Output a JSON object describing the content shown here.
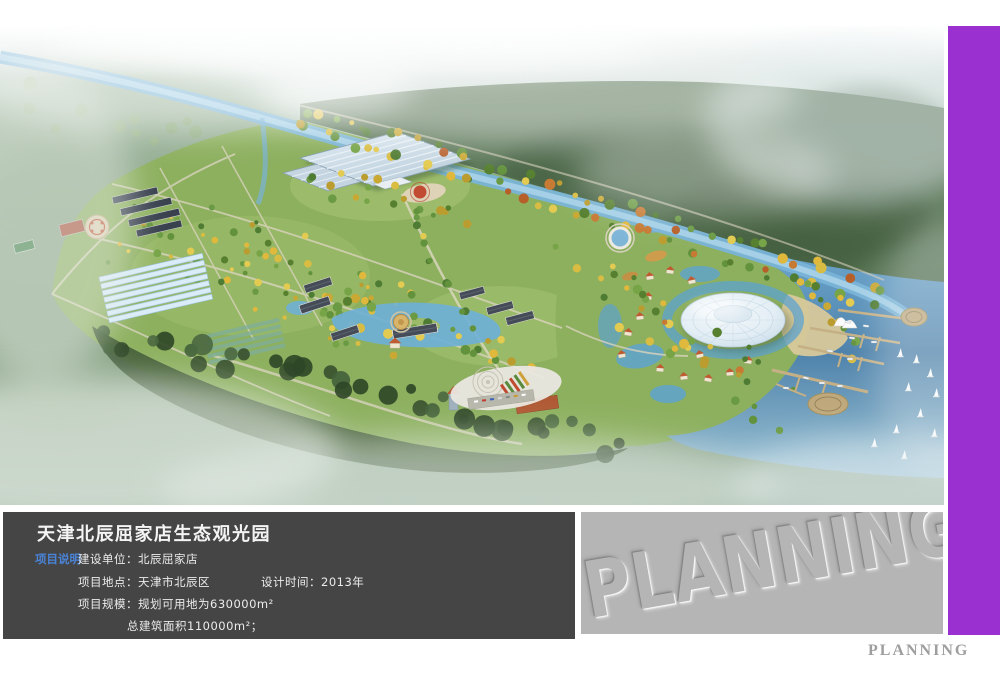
{
  "info_panel": {
    "title": "天津北辰屈家店生态观光园",
    "section_label": "项目说明",
    "construction_unit": "建设单位：北辰屈家店",
    "location": "项目地点：天津市北辰区",
    "design_time": "设计时间：2013年",
    "scale_line1": "项目规模：规划可用地为630000m²",
    "scale_line2": "总建筑面积110000m²；",
    "background_color": "#454545",
    "label_color": "#4a84d8"
  },
  "watermark_panel": {
    "embossed_text": "PLANNING",
    "background_color": "#b5b5b5"
  },
  "footer": {
    "logo_text": "PLANNING",
    "color": "#9e9e9e"
  },
  "accent_bar": {
    "color": "#9a30cf"
  }
}
